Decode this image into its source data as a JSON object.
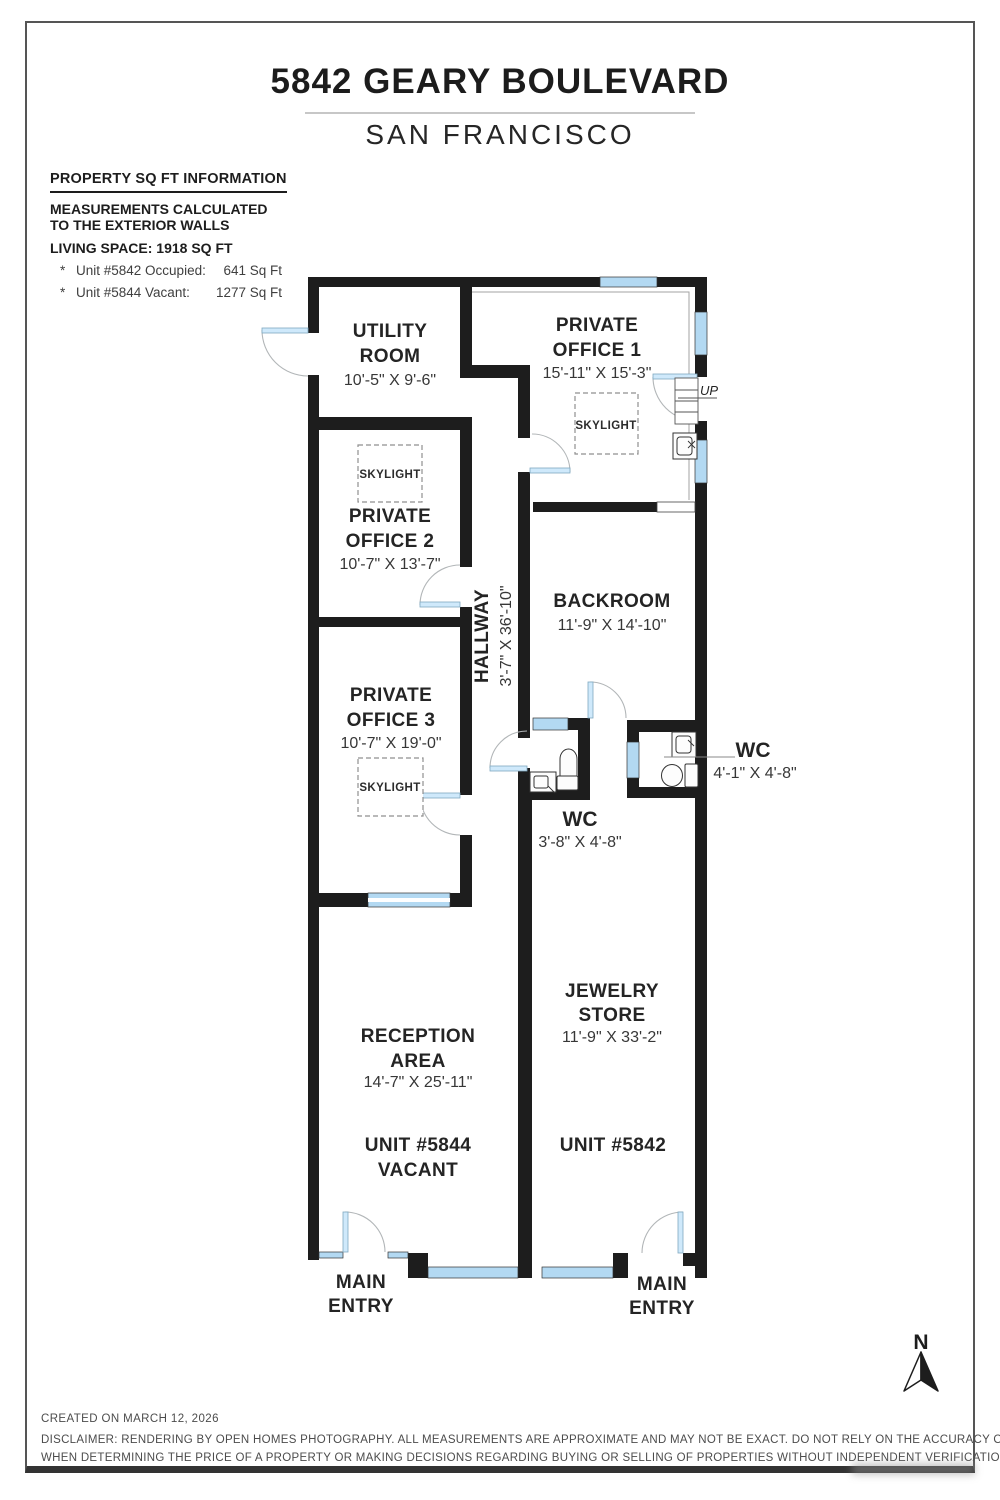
{
  "header": {
    "title": "5842 GEARY BOULEVARD",
    "subtitle": "SAN FRANCISCO"
  },
  "info": {
    "heading": "PROPERTY SQ FT INFORMATION",
    "note_line1": "MEASUREMENTS CALCULATED",
    "note_line2": "TO THE EXTERIOR WALLS",
    "living_space": "LIVING SPACE: 1918 SQ FT",
    "units": [
      {
        "bullet": "*",
        "label": "Unit #5842 Occupied:",
        "value": "641 Sq Ft"
      },
      {
        "bullet": "*",
        "label": "Unit #5844 Vacant:",
        "value": "1277 Sq Ft"
      }
    ]
  },
  "floorplan": {
    "skylight_label": "SKYLIGHT",
    "up_label": "UP",
    "rooms": {
      "utility": {
        "line1": "UTILITY",
        "line2": "ROOM",
        "dims": "10'-5\" X 9'-6\""
      },
      "office1": {
        "line1": "PRIVATE",
        "line2": "OFFICE 1",
        "dims": "15'-11\" X 15'-3\""
      },
      "office2": {
        "line1": "PRIVATE",
        "line2": "OFFICE 2",
        "dims": "10'-7\" X 13'-7\""
      },
      "office3": {
        "line1": "PRIVATE",
        "line2": "OFFICE 3",
        "dims": "10'-7\" X 19'-0\""
      },
      "hallway": {
        "line1": "HALLWAY",
        "dims": "3'-7\" X 36'-10\""
      },
      "backroom": {
        "line1": "BACKROOM",
        "dims": "11'-9\" X 14'-10\""
      },
      "wc_left": {
        "line1": "WC",
        "dims": "3'-8\" X 4'-8\""
      },
      "wc_right": {
        "line1": "WC",
        "dims": "4'-1\" X 4'-8\""
      },
      "jewelry": {
        "line1": "JEWELRY",
        "line2": "STORE",
        "dims": "11'-9\" X 33'-2\""
      },
      "reception": {
        "line1": "RECEPTION",
        "line2": "AREA",
        "dims": "14'-7\" X 25'-11\""
      }
    },
    "units": {
      "unit5844": {
        "line1": "UNIT #5844",
        "line2": "VACANT"
      },
      "unit5842": {
        "line1": "UNIT #5842"
      }
    },
    "entries": {
      "line1": "MAIN",
      "line2": "ENTRY"
    }
  },
  "compass": {
    "north_label": "N"
  },
  "footer": {
    "created": "CREATED ON MARCH 12, 2026",
    "disclaimer_line1": "DISCLAIMER: RENDERING BY OPEN HOMES PHOTOGRAPHY. ALL MEASUREMENTS ARE APPROXIMATE AND MAY NOT BE EXACT. DO NOT RELY ON THE ACCURACY OF THIS FLOOR PLAN",
    "disclaimer_line2": "WHEN DETERMINING THE PRICE OF A PROPERTY OR MAKING DECISIONS REGARDING BUYING OR SELLING OF PROPERTIES WITHOUT INDEPENDENT VERIFICATION."
  }
}
